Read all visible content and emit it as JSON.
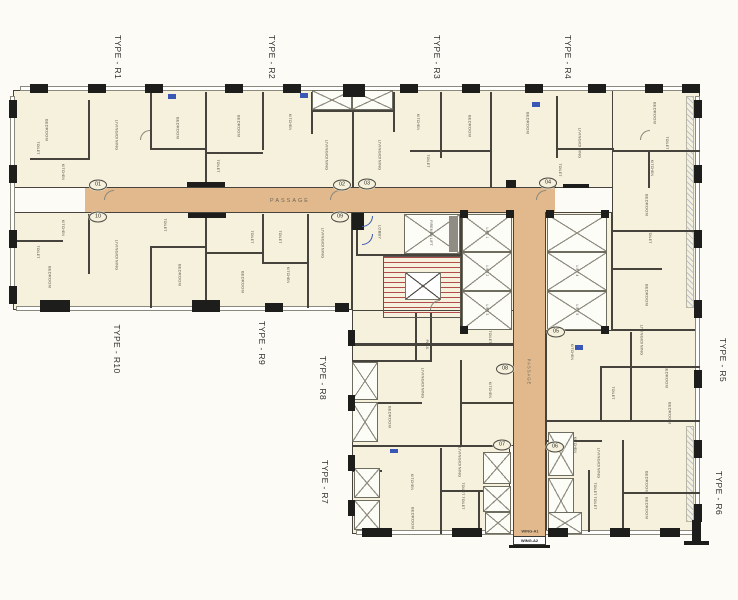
{
  "plan": {
    "unit_types": {
      "r1": "TYPE - R1",
      "r2": "TYPE - R2",
      "r3": "TYPE - R3",
      "r4": "TYPE - R4",
      "r5": "TYPE - R5",
      "r6": "TYPE - R6",
      "r7": "TYPE - R7",
      "r8": "TYPE - R8",
      "r9": "TYPE - R9",
      "r10": "TYPE - R10"
    },
    "unit_numbers": {
      "n01": "01",
      "n02": "02",
      "n03": "03",
      "n04": "04",
      "n05": "05",
      "n06": "06",
      "n07": "07",
      "n08": "08",
      "n09": "09",
      "n10": "10"
    },
    "passage_label": "PASSAGE",
    "wings": {
      "a1": "WING-A1",
      "a2": "WING-A2"
    },
    "core": {
      "lobby": "LOBBY",
      "firemen_lift": "FIREMEN LIFT",
      "lift1": "LIFT 1",
      "lift2": "LIFT 2",
      "lift3": "LIFT 3",
      "lift4": "LIFT 4",
      "lift5": "LIFT 5"
    },
    "rooms": {
      "bedroom": "BEDROOM",
      "living_dining": "LIVING/DINING",
      "kitchen": "KITCHEN",
      "toilet": "TOILET",
      "pass": "PASS."
    },
    "colors": {
      "room_fill": "#f6f1dc",
      "passage_fill": "#e2b98c",
      "wall": "#45433c",
      "column": "#1d1d1b",
      "stair_red": "#b24c4c",
      "accent_blue": "#3a57b5"
    }
  }
}
